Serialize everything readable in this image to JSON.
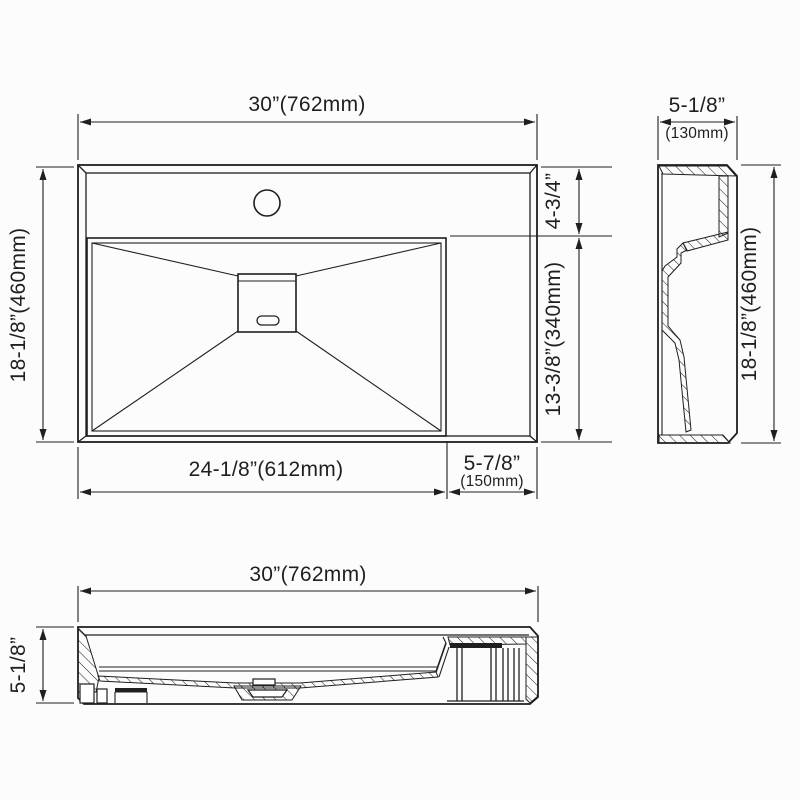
{
  "colors": {
    "line": "#1f1f1f",
    "background": "#fcfcfc"
  },
  "views": {
    "top": {
      "dims": {
        "overall_width": "30”(762mm)",
        "overall_depth": "18-1/8”(460mm)",
        "faucet_deck_depth": "4-3/4”",
        "bowl_depth": "13-3/8”(340mm)",
        "bowl_width": "24-1/8”(612mm)",
        "right_deck_width_in": "5-7/8”",
        "right_deck_width_mm": "(150mm)"
      }
    },
    "side": {
      "dims": {
        "width_in": "5-1/8”",
        "width_mm": "(130mm)",
        "height": "18-1/8”(460mm)"
      }
    },
    "front": {
      "dims": {
        "width": "30”(762mm)",
        "height": "5-1/8”"
      }
    }
  }
}
